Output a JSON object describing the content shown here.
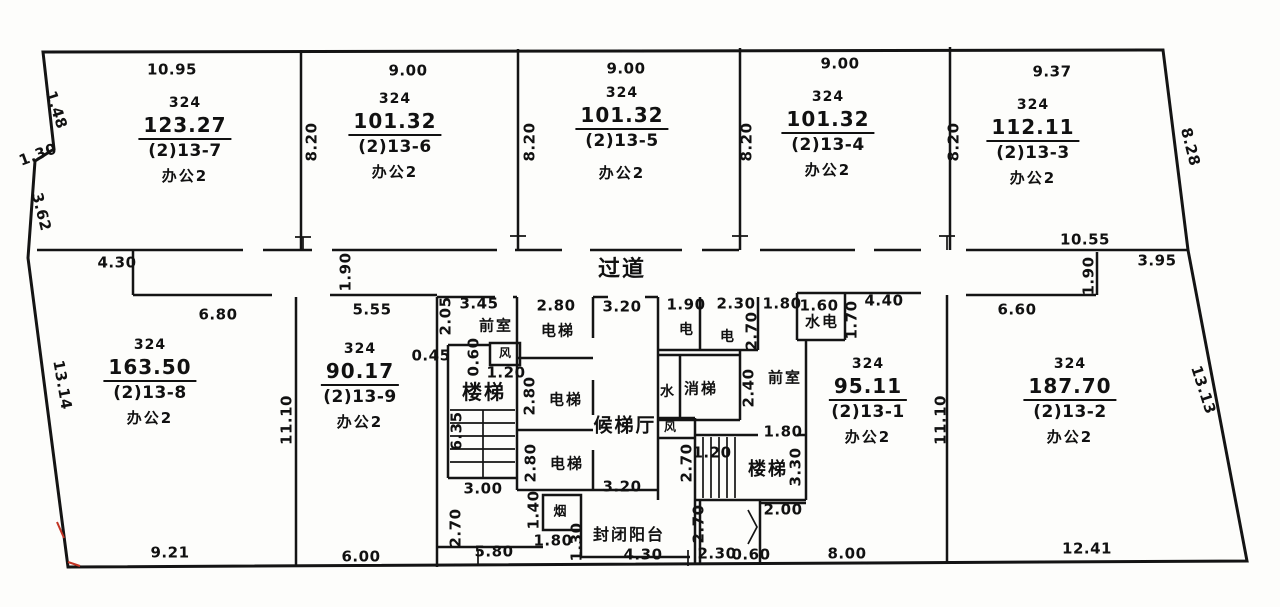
{
  "drawing": {
    "title": "楼层平面图",
    "corridor_label": "过道",
    "line_color": "#141414",
    "mark_color": "#c23424",
    "rooms": [
      {
        "plot": "324",
        "area": "123.27",
        "unit": "(2)13-7",
        "use": "办公2"
      },
      {
        "plot": "324",
        "area": "101.32",
        "unit": "(2)13-6",
        "use": "办公2"
      },
      {
        "plot": "324",
        "area": "101.32",
        "unit": "(2)13-5",
        "use": "办公2"
      },
      {
        "plot": "324",
        "area": "101.32",
        "unit": "(2)13-4",
        "use": "办公2"
      },
      {
        "plot": "324",
        "area": "112.11",
        "unit": "(2)13-3",
        "use": "办公2"
      },
      {
        "plot": "324",
        "area": "163.50",
        "unit": "(2)13-8",
        "use": "办公2"
      },
      {
        "plot": "324",
        "area": "90.17",
        "unit": "(2)13-9",
        "use": "办公2"
      },
      {
        "plot": "324",
        "area": "95.11",
        "unit": "(2)13-1",
        "use": "办公2"
      },
      {
        "plot": "324",
        "area": "187.70",
        "unit": "(2)13-2",
        "use": "办公2"
      }
    ],
    "labels": [
      {
        "text": "10.95",
        "x": 172,
        "y": 70
      },
      {
        "text": "9.00",
        "x": 408,
        "y": 71
      },
      {
        "text": "9.00",
        "x": 626,
        "y": 69
      },
      {
        "text": "9.00",
        "x": 840,
        "y": 64
      },
      {
        "text": "9.37",
        "x": 1052,
        "y": 72
      },
      {
        "text": "1.48",
        "x": 56,
        "y": 110,
        "rot": 72
      },
      {
        "text": "1.30",
        "x": 38,
        "y": 155,
        "rot": -20
      },
      {
        "text": "3.62",
        "x": 41,
        "y": 212,
        "rot": 76
      },
      {
        "text": "13.14",
        "x": 62,
        "y": 385,
        "rot": 80
      },
      {
        "text": "8.28",
        "x": 1190,
        "y": 147,
        "rot": 76
      },
      {
        "text": "13.13",
        "x": 1203,
        "y": 390,
        "rot": 72
      },
      {
        "text": "8.20",
        "x": 312,
        "y": 142,
        "rot": -90
      },
      {
        "text": "8.20",
        "x": 530,
        "y": 142,
        "rot": -90
      },
      {
        "text": "8.20",
        "x": 747,
        "y": 142,
        "rot": -90
      },
      {
        "text": "8.20",
        "x": 954,
        "y": 142,
        "rot": -90
      },
      {
        "text": "4.30",
        "x": 117,
        "y": 263
      },
      {
        "text": "1.90",
        "x": 346,
        "y": 272,
        "rot": -90
      },
      {
        "text": "6.80",
        "x": 218,
        "y": 315
      },
      {
        "text": "5.55",
        "x": 372,
        "y": 310
      },
      {
        "text": "过道",
        "x": 622,
        "y": 270,
        "size": 22,
        "cjk": true
      },
      {
        "text": "10.55",
        "x": 1085,
        "y": 240
      },
      {
        "text": "3.95",
        "x": 1157,
        "y": 261
      },
      {
        "text": "1.90",
        "x": 1089,
        "y": 276,
        "rot": -90
      },
      {
        "text": "6.60",
        "x": 1017,
        "y": 310
      },
      {
        "text": "2.05",
        "x": 446,
        "y": 316,
        "rot": -90
      },
      {
        "text": "3.45",
        "x": 479,
        "y": 304
      },
      {
        "text": "前室",
        "x": 496,
        "y": 326,
        "cjk": true
      },
      {
        "text": "0.45",
        "x": 431,
        "y": 356
      },
      {
        "text": "0.60",
        "x": 474,
        "y": 357,
        "rot": -90
      },
      {
        "text": "风",
        "x": 506,
        "y": 353,
        "size": 12,
        "cjk": true
      },
      {
        "text": "1.20",
        "x": 506,
        "y": 373
      },
      {
        "text": "楼梯",
        "x": 484,
        "y": 392,
        "size": 20,
        "cjk": true
      },
      {
        "text": "6.35",
        "x": 457,
        "y": 431,
        "rot": -90
      },
      {
        "text": "2.80",
        "x": 556,
        "y": 306
      },
      {
        "text": "电梯",
        "x": 558,
        "y": 331,
        "cjk": true
      },
      {
        "text": "3.20",
        "x": 622,
        "y": 307
      },
      {
        "text": "2.80",
        "x": 530,
        "y": 396,
        "rot": -90
      },
      {
        "text": "电梯",
        "x": 566,
        "y": 400,
        "cjk": true
      },
      {
        "text": "候梯厅",
        "x": 625,
        "y": 426,
        "size": 19,
        "cjk": true
      },
      {
        "text": "2.80",
        "x": 531,
        "y": 463,
        "rot": -90
      },
      {
        "text": "电梯",
        "x": 567,
        "y": 464,
        "cjk": true
      },
      {
        "text": "3.00",
        "x": 483,
        "y": 489
      },
      {
        "text": "3.20",
        "x": 622,
        "y": 487
      },
      {
        "text": "2.70",
        "x": 456,
        "y": 528,
        "rot": -90
      },
      {
        "text": "1.40",
        "x": 534,
        "y": 510,
        "rot": -90
      },
      {
        "text": "烟",
        "x": 561,
        "y": 512,
        "size": 13,
        "cjk": true
      },
      {
        "text": "1.80",
        "x": 553,
        "y": 541
      },
      {
        "text": "1.30",
        "x": 577,
        "y": 542,
        "rot": -90
      },
      {
        "text": "封闭阳台",
        "x": 629,
        "y": 535,
        "size": 16,
        "cjk": true
      },
      {
        "text": "4.30",
        "x": 643,
        "y": 555
      },
      {
        "text": "5.80",
        "x": 494,
        "y": 552
      },
      {
        "text": "1.90",
        "x": 686,
        "y": 305
      },
      {
        "text": "电",
        "x": 687,
        "y": 330,
        "size": 14,
        "cjk": true
      },
      {
        "text": "2.30",
        "x": 736,
        "y": 304
      },
      {
        "text": "电",
        "x": 728,
        "y": 337,
        "size": 14,
        "cjk": true
      },
      {
        "text": "2.70",
        "x": 752,
        "y": 331,
        "rot": -90
      },
      {
        "text": "1.80",
        "x": 782,
        "y": 304
      },
      {
        "text": "1.60",
        "x": 819,
        "y": 306
      },
      {
        "text": "水电",
        "x": 822,
        "y": 322,
        "cjk": true
      },
      {
        "text": "1.70",
        "x": 852,
        "y": 320,
        "rot": -90
      },
      {
        "text": "4.40",
        "x": 884,
        "y": 301
      },
      {
        "text": "水",
        "x": 668,
        "y": 392,
        "size": 14,
        "cjk": true
      },
      {
        "text": "消梯",
        "x": 701,
        "y": 389,
        "cjk": true
      },
      {
        "text": "2.40",
        "x": 749,
        "y": 388,
        "rot": -90
      },
      {
        "text": "前室",
        "x": 785,
        "y": 378,
        "cjk": true
      },
      {
        "text": "风",
        "x": 671,
        "y": 427,
        "size": 12,
        "cjk": true
      },
      {
        "text": "1.80",
        "x": 783,
        "y": 432
      },
      {
        "text": "1.20",
        "x": 712,
        "y": 453
      },
      {
        "text": "2.70",
        "x": 687,
        "y": 463,
        "rot": -90
      },
      {
        "text": "楼梯",
        "x": 768,
        "y": 470,
        "size": 18,
        "cjk": true
      },
      {
        "text": "3.30",
        "x": 796,
        "y": 467,
        "rot": -90
      },
      {
        "text": "2.00",
        "x": 783,
        "y": 510
      },
      {
        "text": "2.70",
        "x": 699,
        "y": 524,
        "rot": -90
      },
      {
        "text": "2.30",
        "x": 717,
        "y": 554
      },
      {
        "text": "0.60",
        "x": 751,
        "y": 555
      },
      {
        "text": "8.00",
        "x": 847,
        "y": 554
      },
      {
        "text": "11.10",
        "x": 287,
        "y": 420,
        "rot": -90
      },
      {
        "text": "11.10",
        "x": 941,
        "y": 420,
        "rot": -90
      },
      {
        "text": "9.21",
        "x": 170,
        "y": 553
      },
      {
        "text": "6.00",
        "x": 361,
        "y": 557
      },
      {
        "text": "12.41",
        "x": 1087,
        "y": 549
      }
    ]
  }
}
